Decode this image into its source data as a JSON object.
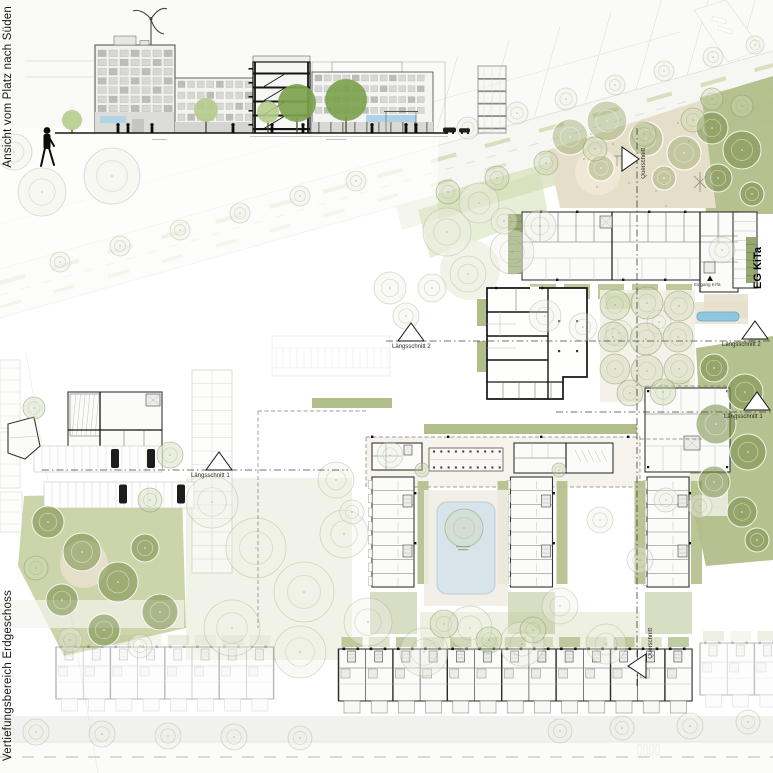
{
  "sheet": {
    "side_title_top": "Ansicht vom Platz nach Süden",
    "side_title_bottom": "Vertiefungsbereich Erdgeschoss"
  },
  "plan_labels": {
    "laengsschnitt_1": "Längsschnitt 1",
    "laengsschnitt_2": "Längsschnitt 2",
    "querschnitt": "Querschnitt",
    "eg_kita": "EG KiTa",
    "eingang_kita": "Eingang KiTa"
  },
  "colors": {
    "green": "#b2be8a",
    "green-l": "#d2dbb2",
    "beige": "#e5dfca",
    "water": "#d7e5ea",
    "waterf": "#8ec6de",
    "road": "#f6f6f3",
    "ink": "#161616"
  }
}
